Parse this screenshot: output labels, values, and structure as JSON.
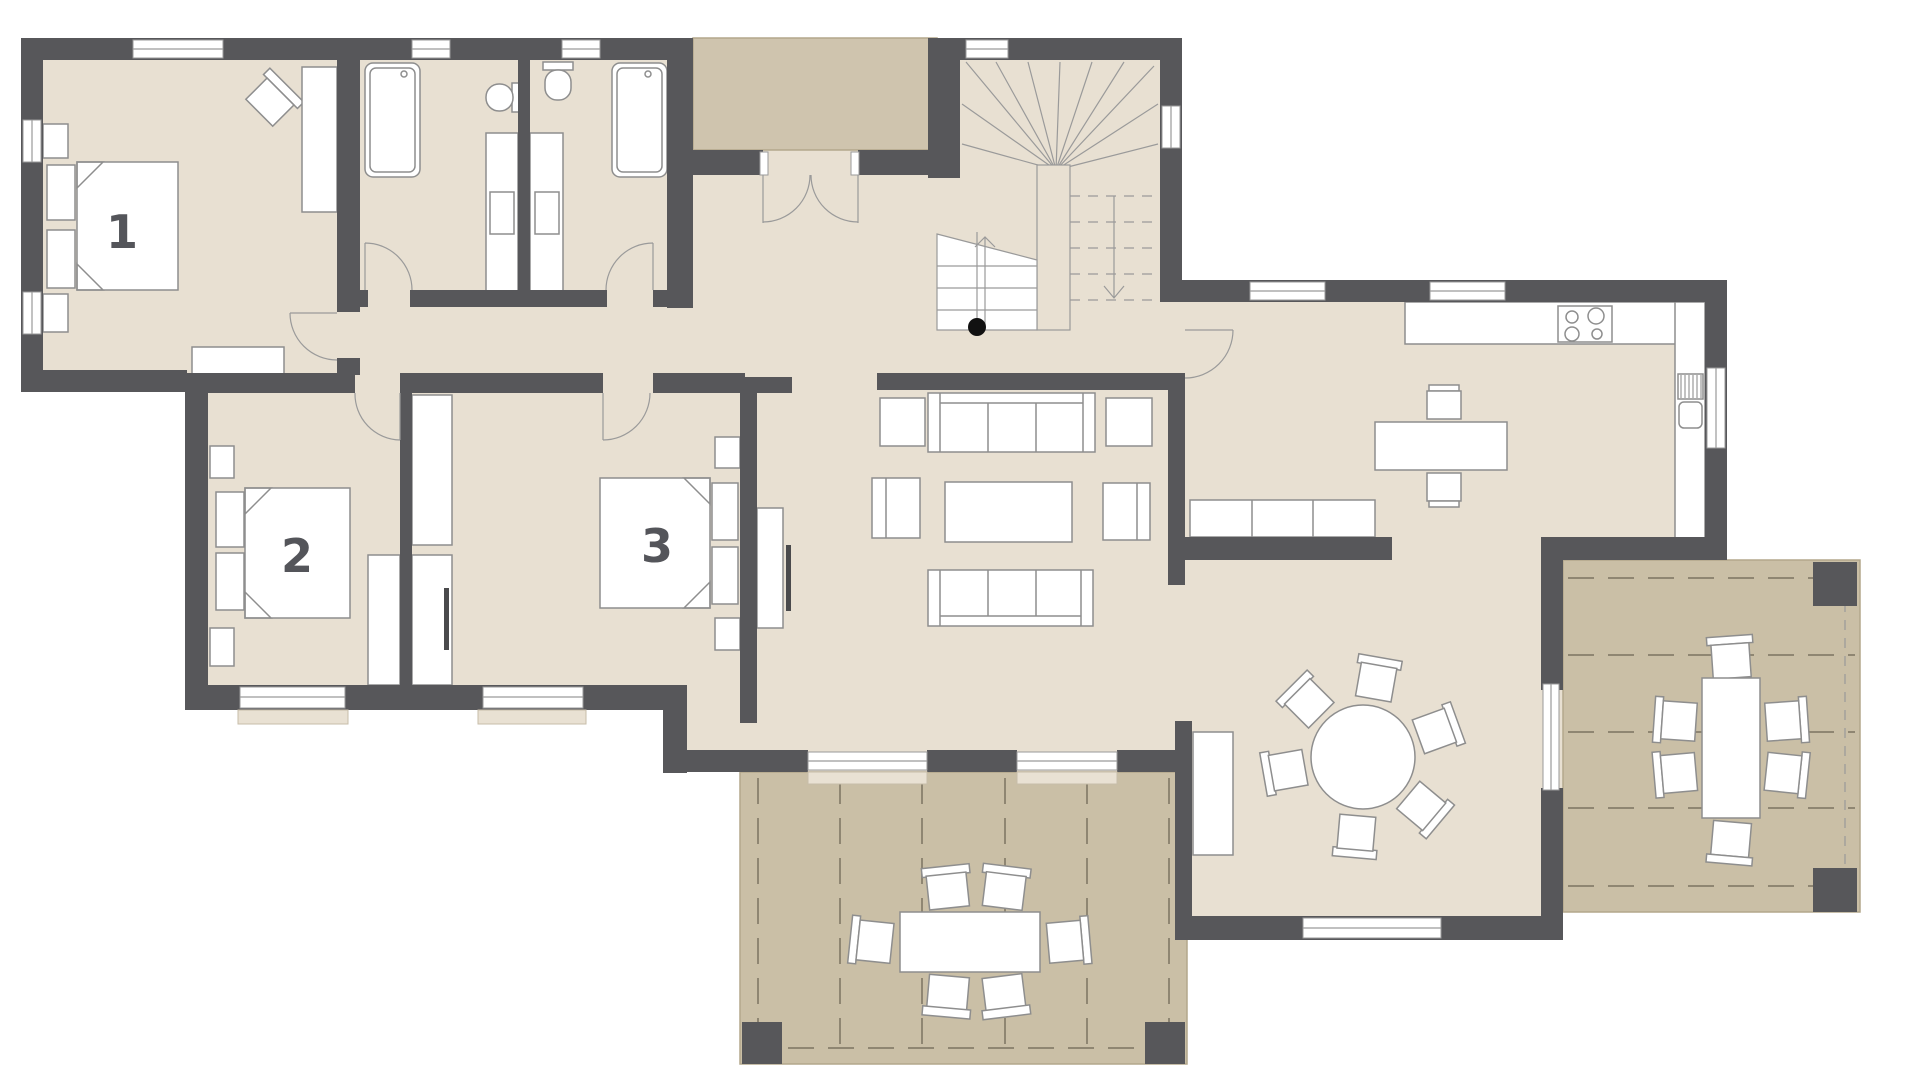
{
  "page": {
    "background": "#ffffff"
  },
  "plan": {
    "type": "architectural-floor-plan",
    "floor_color": "#e8e0d2",
    "wall_color": "#57575a",
    "terrace_color": "#cabfa6",
    "porch_color": "#cfc4ae",
    "furniture_stroke": "#8e8e8e",
    "rooms": [
      {
        "id": "bedroom-1",
        "label": "1"
      },
      {
        "id": "bedroom-2",
        "label": "2"
      },
      {
        "id": "bedroom-3",
        "label": "3"
      }
    ]
  }
}
